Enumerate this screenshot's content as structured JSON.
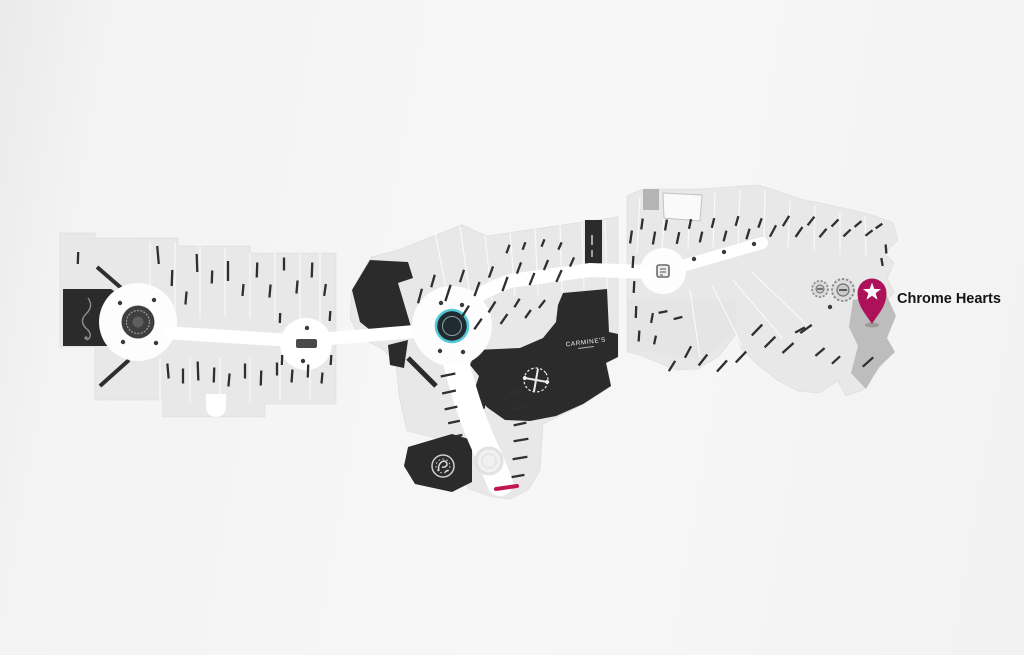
{
  "map": {
    "pin": {
      "label": "Chrome Hearts",
      "color": "#ad1159",
      "icon": "star-pin"
    },
    "stores": {
      "carmines_label": "CARMINE'S"
    },
    "colors": {
      "background": "#f4f4f4",
      "store_light": "#e8e8e8",
      "store_dark": "#2b2b2b",
      "store_selected": "#bdbdbd",
      "walkway": "#ffffff",
      "accent_teal": "#55c8d8",
      "entrance_red": "#c2164e",
      "label_ink": "#141414"
    }
  }
}
